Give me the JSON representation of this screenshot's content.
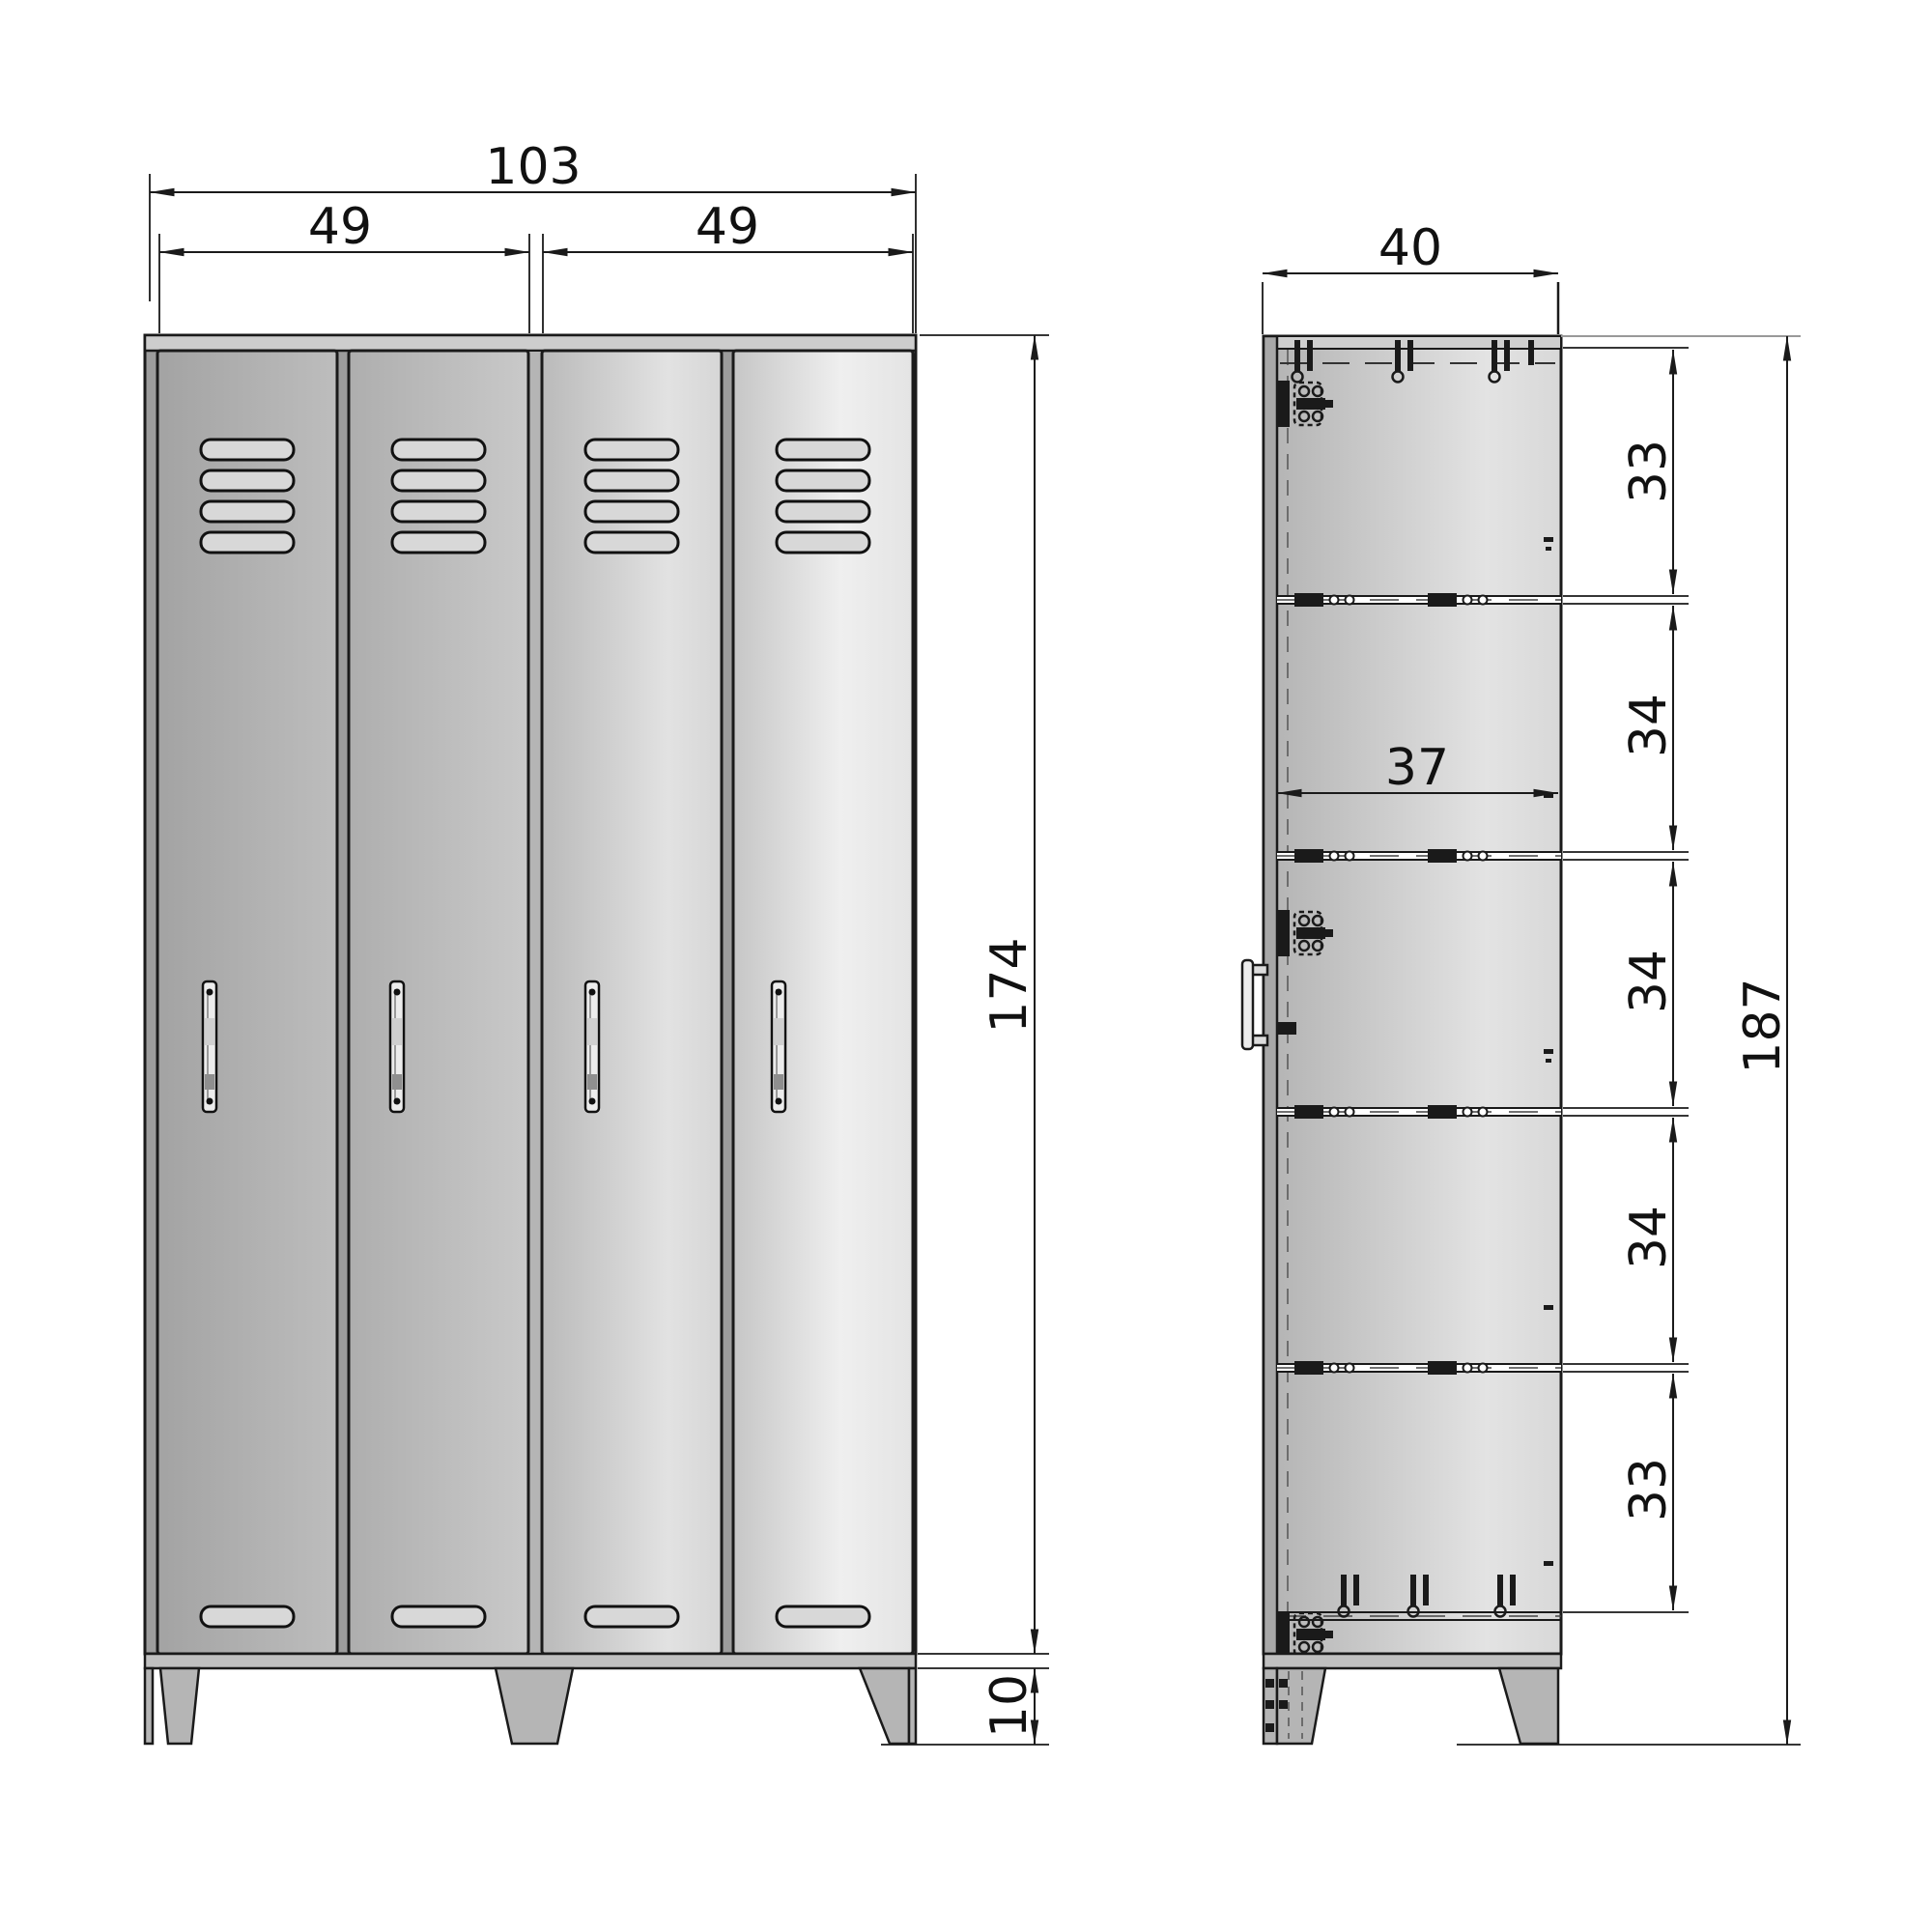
{
  "drawing": {
    "front": {
      "overall_width": "103",
      "left_bay_width": "49",
      "right_bay_width": "49",
      "body_height": "174",
      "feet_height": "10"
    },
    "side": {
      "depth": "40",
      "inner_depth": "37",
      "sections": [
        "33",
        "34",
        "34",
        "34",
        "33"
      ],
      "overall_height": "187"
    },
    "colors": {
      "line": "#1a1a1a",
      "door_dark": "#a8a8a8",
      "door_light": "#ececec",
      "cap": "#cdcdcd",
      "frame": "#9c9c9c",
      "background": "#ffffff"
    }
  }
}
